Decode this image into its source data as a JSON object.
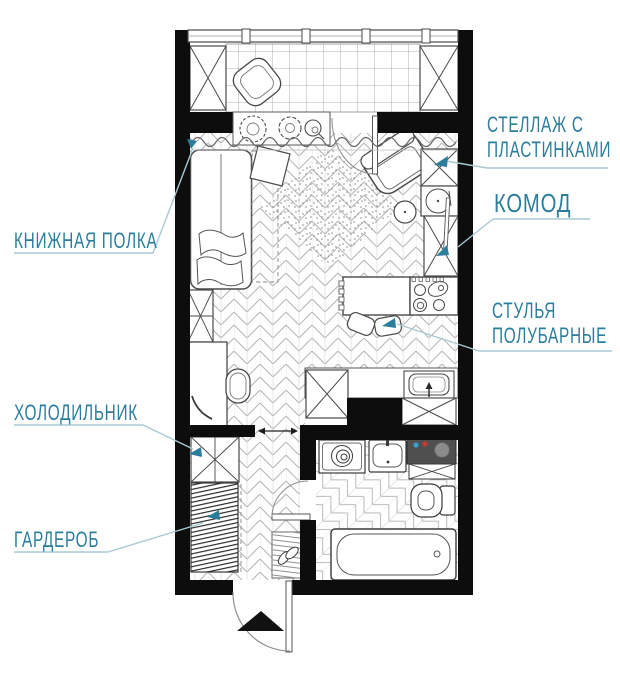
{
  "title": "studio-apartment-floor-plan",
  "labels": {
    "bookshelf": "КНИЖНАЯ ПОЛКА",
    "record_shelf_line1": "СТЕЛЛАЖ С",
    "record_shelf_line2": "ПЛАСТИНКАМИ",
    "dresser": "КОМОД",
    "bar_stools_line1": "СТУЛЬЯ",
    "bar_stools_line2": "ПОЛУБАРНЫЕ",
    "refrigerator": "ХОЛОДИЛЬНИК",
    "wardrobe": "ГАРДЕРОБ"
  },
  "colors": {
    "label_text": "#2b7d9c",
    "leader_line": "#a9c8d4",
    "teal_arrow": "#2b7d9c",
    "wall": "#0d0d0d",
    "outline": "#4a4a4a",
    "water_heater": "#4f4f4f",
    "heater_dot_blue": "#3b9ec9",
    "heater_dot_red": "#bf3b34"
  },
  "plan": {
    "elements": [
      "balcony",
      "balcony-window",
      "balcony-storage-left",
      "balcony-storage-right",
      "balcony-chair",
      "balcony-door",
      "plants-sill",
      "curtain",
      "bed",
      "bedside-table",
      "fold-out-zone",
      "rug",
      "armchair",
      "side-table",
      "record-shelf",
      "turntable",
      "dresser",
      "leaning-board",
      "bar-table",
      "bar-stools",
      "stove",
      "kitchen-counter",
      "kitchen-sink",
      "kitchen-cabinet",
      "shelf-box",
      "desk",
      "desk-chair",
      "refrigerator",
      "wardrobe",
      "hallway",
      "doorway-arrow",
      "bathroom-door",
      "doormat-with-shoes",
      "washing-machine",
      "bathroom-sink",
      "water-heater",
      "under-heater-cabinet",
      "toilet",
      "bathtub",
      "entrance-door",
      "entry-direction-arrow"
    ]
  }
}
